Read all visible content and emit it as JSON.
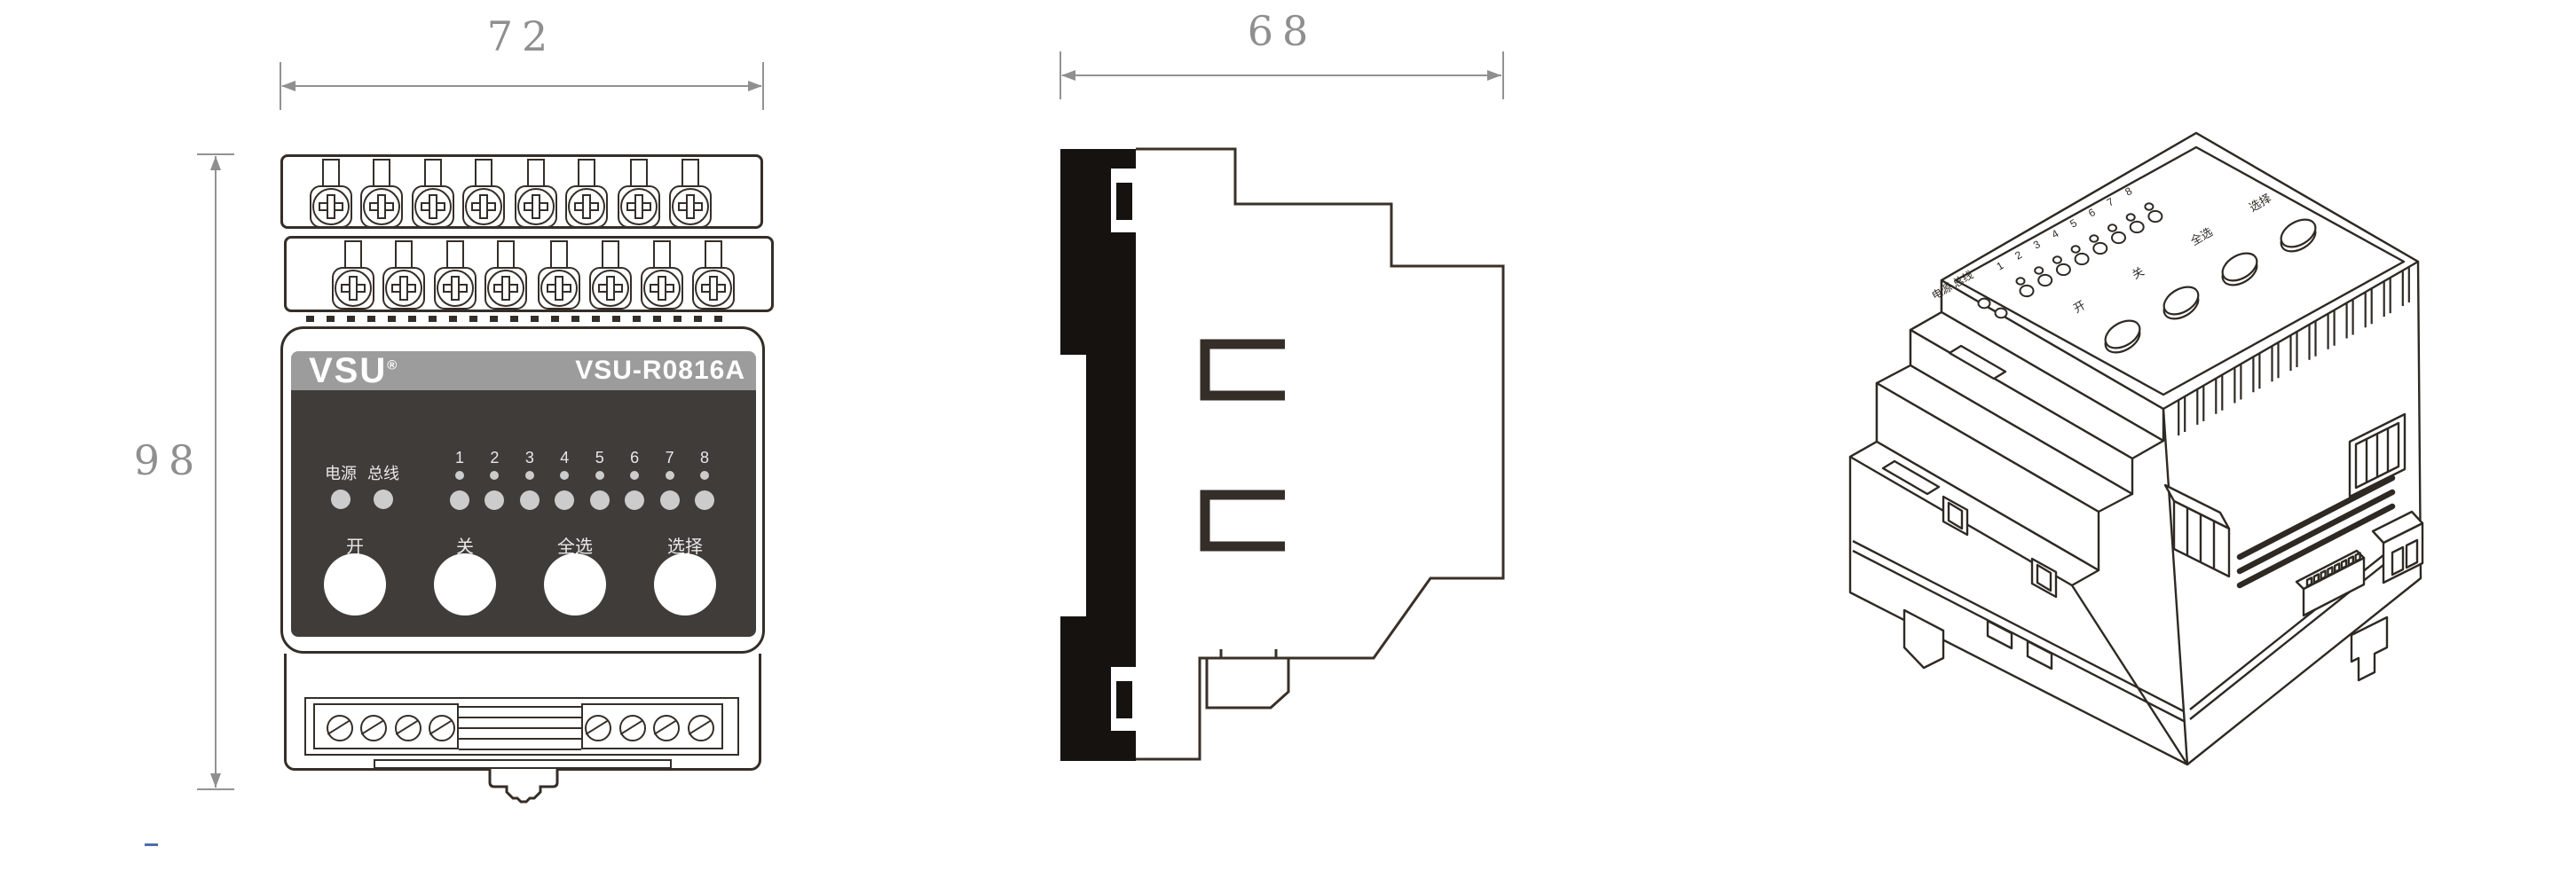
{
  "product": {
    "brand": "VSU",
    "registered_mark": "®",
    "model": "VSU-R0816A",
    "description": "导轨式8路16A智能照明模块"
  },
  "dimensions": {
    "width_mm": "72",
    "height_mm": "98",
    "depth_mm": "68"
  },
  "front_panel": {
    "power_led_label": "电源",
    "bus_led_label": "总线",
    "channel_labels": [
      "1",
      "2",
      "3",
      "4",
      "5",
      "6",
      "7",
      "8"
    ],
    "buttons": [
      {
        "label": "开"
      },
      {
        "label": "关"
      },
      {
        "label": "全选"
      },
      {
        "label": "选择"
      }
    ]
  },
  "colors": {
    "line": "#352e28",
    "panel_dark": "#403c3a",
    "header_gray": "#9c9c9c",
    "led_gray": "#cccccc",
    "dim_gray": "#8f8f8f",
    "accent_blue": "#4f6cb0"
  }
}
